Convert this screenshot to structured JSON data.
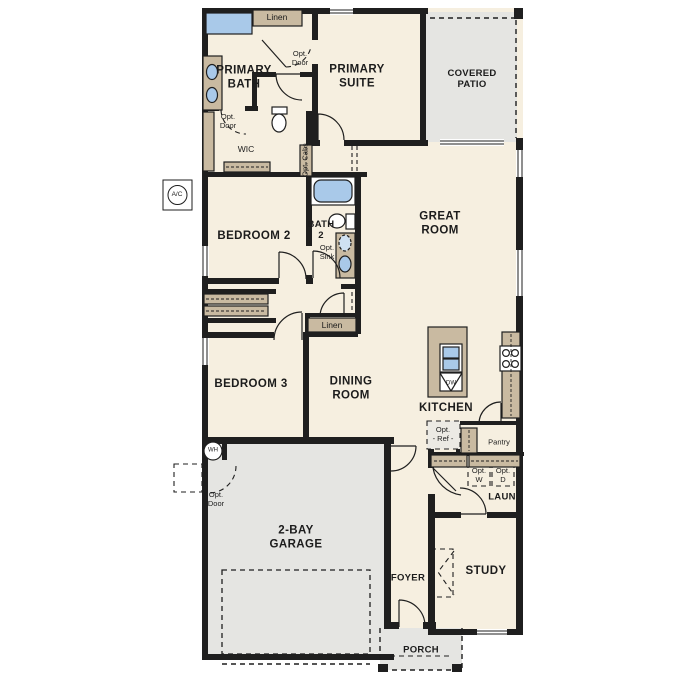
{
  "colors": {
    "wall": "#1f1f1f",
    "floor": "#f6efe0",
    "outdoor_concrete": "#e5e5e2",
    "cabinet_tan": "#c9baa1",
    "fixture_blue": "#a9c9e9",
    "text": "#1c1c1c",
    "background": "#ffffff"
  },
  "rooms": {
    "primary_bath": "PRIMARY\nBATH",
    "primary_suite": "PRIMARY\nSUITE",
    "covered_patio": "COVERED\nPATIO",
    "wic": "WIC",
    "bedroom_2": "BEDROOM 2",
    "bath_2": "BATH\n2",
    "great_room": "GREAT\nROOM",
    "bedroom_3": "BEDROOM 3",
    "dining_room": "DINING\nROOM",
    "kitchen": "KITCHEN",
    "laundry": "LAUN",
    "foyer": "FOYER",
    "study": "STUDY",
    "garage": "2-BAY\nGARAGE",
    "porch": "PORCH"
  },
  "closets": {
    "linen_primary": "Linen",
    "linen_hall": "Linen",
    "pantry": "Pantry"
  },
  "options": {
    "opt_door_primary": "Opt.\nDoor",
    "opt_door_wic": "Opt.\nDoor",
    "opt_door_garage": "Opt.\nDoor",
    "opt_sink": "Opt.\nSink",
    "opt_cabs": "Opt. Cabs",
    "opt_ref": "Opt.\n- Ref -",
    "opt_washer": "Opt.\nW",
    "opt_dryer": "Opt.\nD"
  },
  "equipment": {
    "ac_unit": "A/C",
    "water_heater": "WH",
    "dishwasher": "DW"
  }
}
